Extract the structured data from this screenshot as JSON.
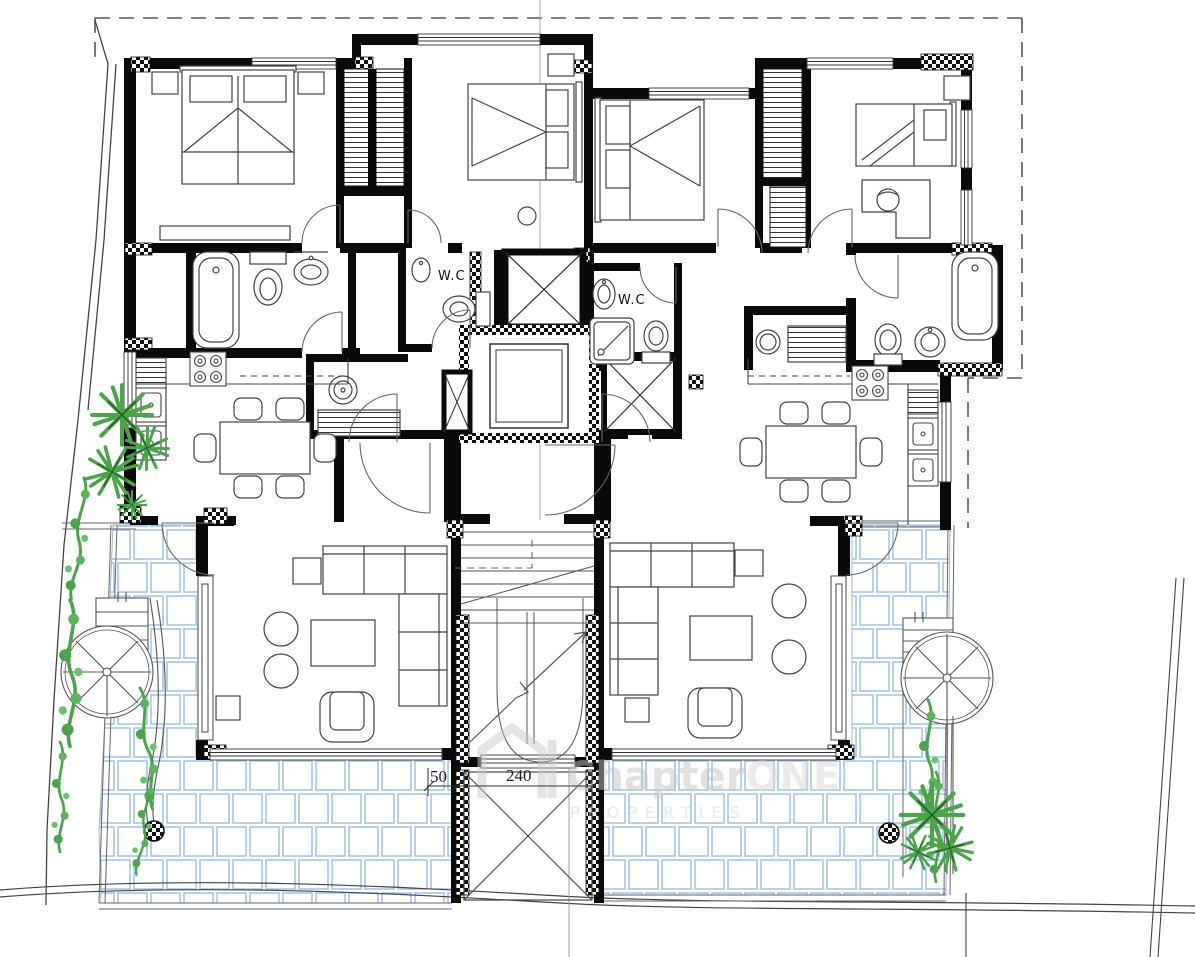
{
  "drawing": {
    "type": "architectural-floor-plan",
    "labels": {
      "wc_left": "W.C",
      "wc_right": "W.C"
    },
    "dimensions": {
      "dim_small": "50",
      "dim_large": "240"
    },
    "watermark": {
      "brand_primary": "Chapter",
      "brand_secondary": "ONE",
      "subtitle": "PROPERTIES"
    },
    "colors": {
      "wall": "#0a0a0a",
      "tile_blue": "#a5c4e6",
      "plant_green": "#4da24d",
      "watermark_gray": "#c9c9c9",
      "boundary": "#555555"
    }
  }
}
